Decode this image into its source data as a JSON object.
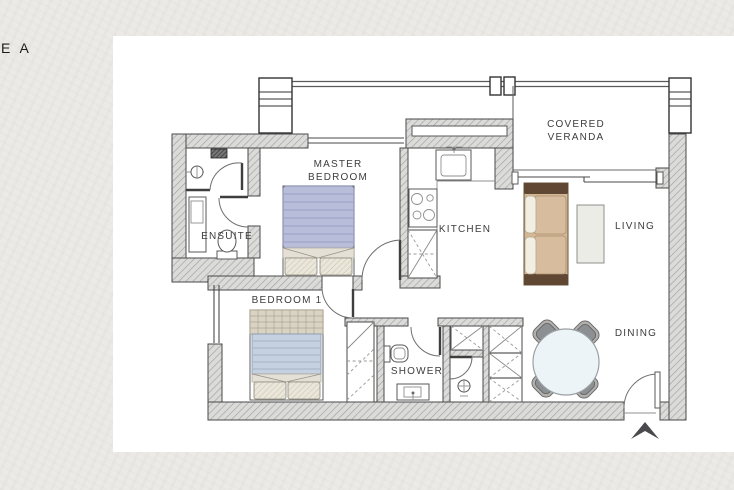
{
  "page": {
    "corner_label": "E A",
    "background_color": "#ecEAe6",
    "card_color": "#ffffff"
  },
  "plan": {
    "rooms": {
      "master_bedroom": {
        "line1": "MASTER",
        "line2": "BEDROOM"
      },
      "ensuite": {
        "line1": "ENSUITE"
      },
      "bedroom_1": {
        "line1": "BEDROOM 1"
      },
      "kitchen": {
        "line1": "KITCHEN"
      },
      "shower": {
        "line1": "SHOWER"
      },
      "covered_veranda": {
        "line1": "COVERED",
        "line2": "VERANDA"
      },
      "living": {
        "line1": "LIVING"
      },
      "dining": {
        "line1": "DINING"
      }
    },
    "icons": {
      "entrance_arrow": "entrance-direction-arrow",
      "shower_head_ensuite": "shower-head",
      "shower_head_bath": "shower-head",
      "faucet": "faucet"
    },
    "colors": {
      "wall_fill": "#dbdbda",
      "wall_hatch": "#a5a5a3",
      "outline": "#4a4a4a",
      "master_duvet": "#b8bdda",
      "bed1_duvet": "#c5d1e1",
      "bed1_plaid": "#d9d3c3",
      "pillow_fill": "#eae6da",
      "fold_fill": "#e4e0d5",
      "sofa_body": "#d4b896",
      "sofa_frame": "#5f4733",
      "sofa_cushion": "#d7bd9e",
      "sofa_pillow": "#f2eee3",
      "coffee_table": "#ebece6",
      "dining_table": "#edf4f8",
      "chair": "#8d9093",
      "chair_band": "#b3b0aa",
      "arrow": "#4a4a4e",
      "label_text": "#3d3d3d"
    }
  }
}
